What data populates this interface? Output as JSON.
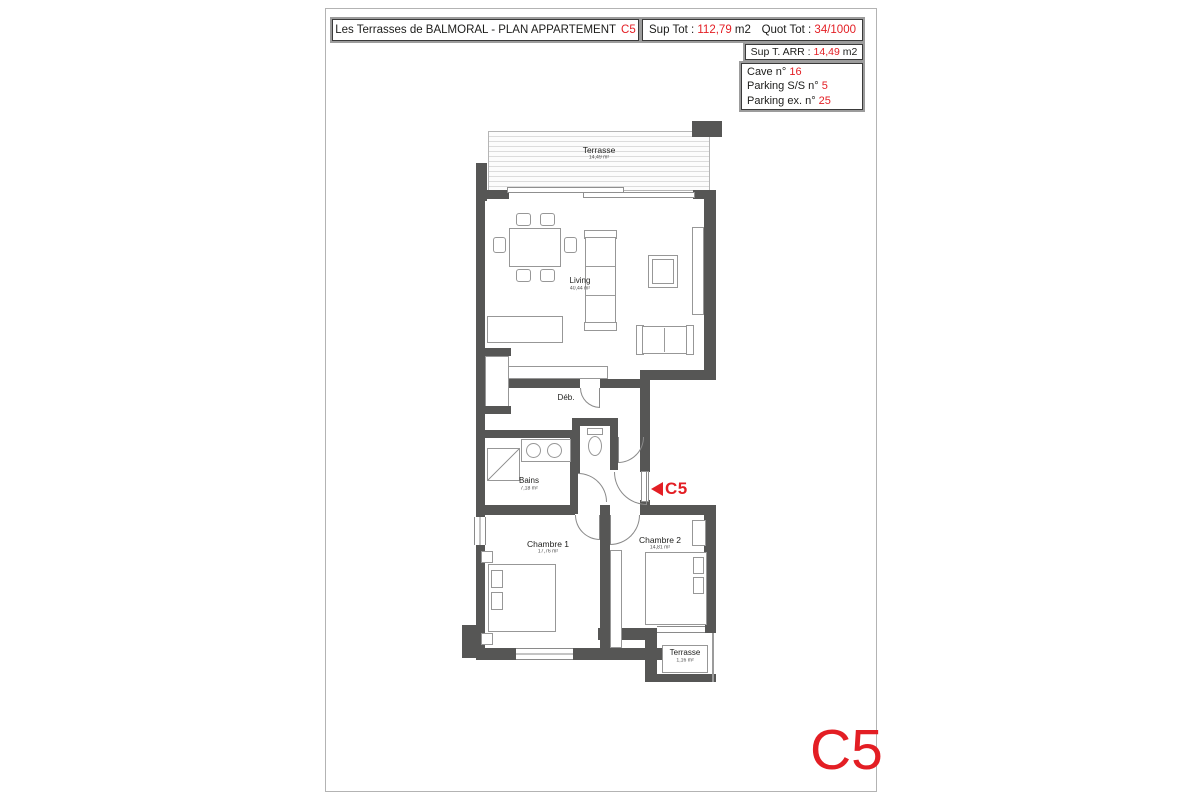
{
  "header": {
    "title": {
      "text": "Les Terrasses de BALMORAL - PLAN APPARTEMENT",
      "unit": "C5"
    },
    "sup_tot": {
      "label": "Sup Tot :",
      "value": "112,79",
      "unit": "m2"
    },
    "quot_tot": {
      "label": "Quot Tot :",
      "value": "34/1000"
    },
    "sup_t_arr": {
      "label": "Sup T. ARR :",
      "value": "14,49",
      "unit": "m2"
    },
    "annex": {
      "cave": {
        "label": "Cave n°",
        "value": "16"
      },
      "parking_ss": {
        "label": "Parking S/S n°",
        "value": "5"
      },
      "parking_ex": {
        "label": "Parking ex. n°",
        "value": "25"
      }
    }
  },
  "plan": {
    "rooms": {
      "terrasse_top": {
        "name": "Terrasse",
        "area": "14,49 m²"
      },
      "living": {
        "name": "Living",
        "area": "40,44 m²"
      },
      "deb": {
        "name": "Déb."
      },
      "bains": {
        "name": "Bains",
        "area": "7,18 m²"
      },
      "chambre1": {
        "name": "Chambre 1",
        "area": "17,76 m²"
      },
      "chambre2": {
        "name": "Chambre 2",
        "area": "14,81 m²"
      },
      "terrasse_bottom": {
        "name": "Terrasse",
        "area": "1,16 m²"
      }
    },
    "entrance": {
      "label": "C5"
    }
  },
  "footer": {
    "unit_code": "C5"
  },
  "colors": {
    "accent_red": "#e31e24",
    "wall_gray": "#565655"
  }
}
